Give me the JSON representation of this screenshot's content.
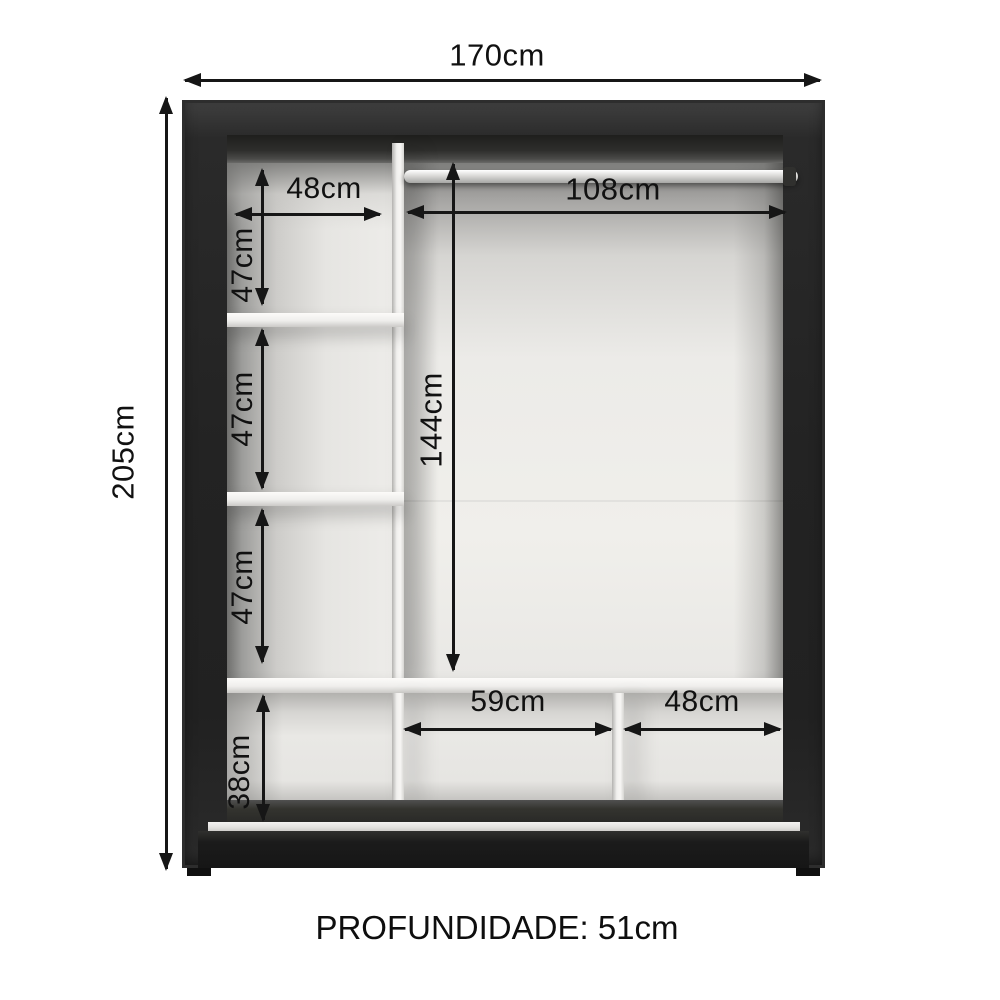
{
  "diagram": {
    "type": "wardrobe-internal-dimensions",
    "overall": {
      "width": "170cm",
      "height": "205cm",
      "depth": "51cm"
    },
    "labels": {
      "total_width": "170cm",
      "total_height": "205cm",
      "left_shelf_width": "48cm",
      "left_comp1_height": "47cm",
      "left_comp2_height": "47cm",
      "left_comp3_height": "47cm",
      "bottom_left_height": "38cm",
      "hanging_width": "108cm",
      "hanging_height": "144cm",
      "bottom_middle_width": "59cm",
      "bottom_right_width": "48cm"
    },
    "footer": "PROFUNDIDADE: 51cm",
    "colors": {
      "background": "#ffffff",
      "frame": "#242424",
      "interior": "#eae9e6",
      "dividers": "#f3f2f0",
      "dimension_lines": "#161616",
      "text": "#111111"
    }
  }
}
